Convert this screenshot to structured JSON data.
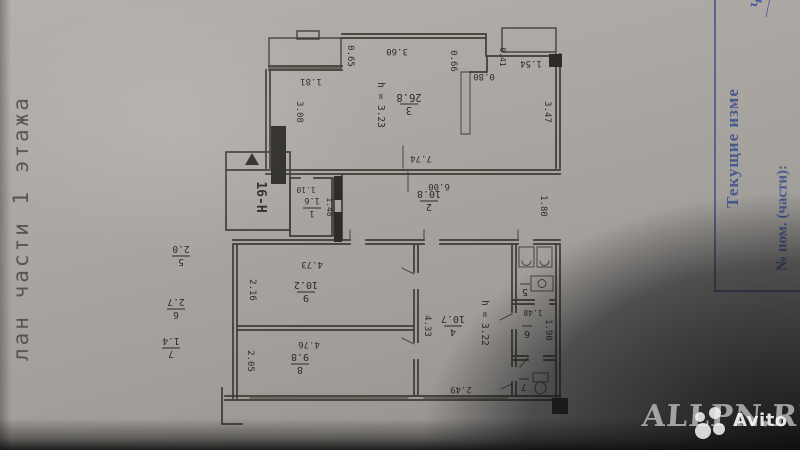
{
  "caption": {
    "side_text": "лан части 1 этажа"
  },
  "stamp": {
    "header": "Текущие изме",
    "row_label": "№ пом. (части):",
    "handwritten": "ч. п. 2"
  },
  "watermark": {
    "site": "ALLPN.RU",
    "logo_text": "Avito"
  },
  "plan": {
    "unit_label": "16-Н",
    "rooms": {
      "r1": {
        "no": "1",
        "area": "1.6"
      },
      "r2": {
        "no": "2",
        "area": "10.8"
      },
      "r3": {
        "no": "3",
        "area": "26.8",
        "height": "h = 3.23"
      },
      "r4": {
        "no": "4",
        "area": "10.7",
        "height": "h = 3.22"
      },
      "r5": {
        "no": "5",
        "area": "2.0"
      },
      "r6": {
        "no": "6",
        "area": "2.7"
      },
      "r7": {
        "no": "7",
        "area": "1.4"
      },
      "r8": {
        "no": "8",
        "area": "9.8"
      },
      "r9": {
        "no": "9",
        "area": "10.2"
      }
    },
    "dims": {
      "d360": "3.60",
      "d065": "0.65",
      "d181": "1.81",
      "d308": "3.08",
      "d066": "0.66",
      "d080": "0.80",
      "d041": "0.41",
      "d154": "1.54",
      "d347": "3.47",
      "d774": "7.74",
      "d600": "6.00",
      "d180": "1.80",
      "d110": "1.10",
      "d148": "1.48",
      "d473": "4.73",
      "d216": "2.16",
      "d476": "4.76",
      "d205": "2.05",
      "d433": "4.33",
      "d249": "2.49",
      "d148b": "1.48",
      "d190": "1.90"
    }
  }
}
